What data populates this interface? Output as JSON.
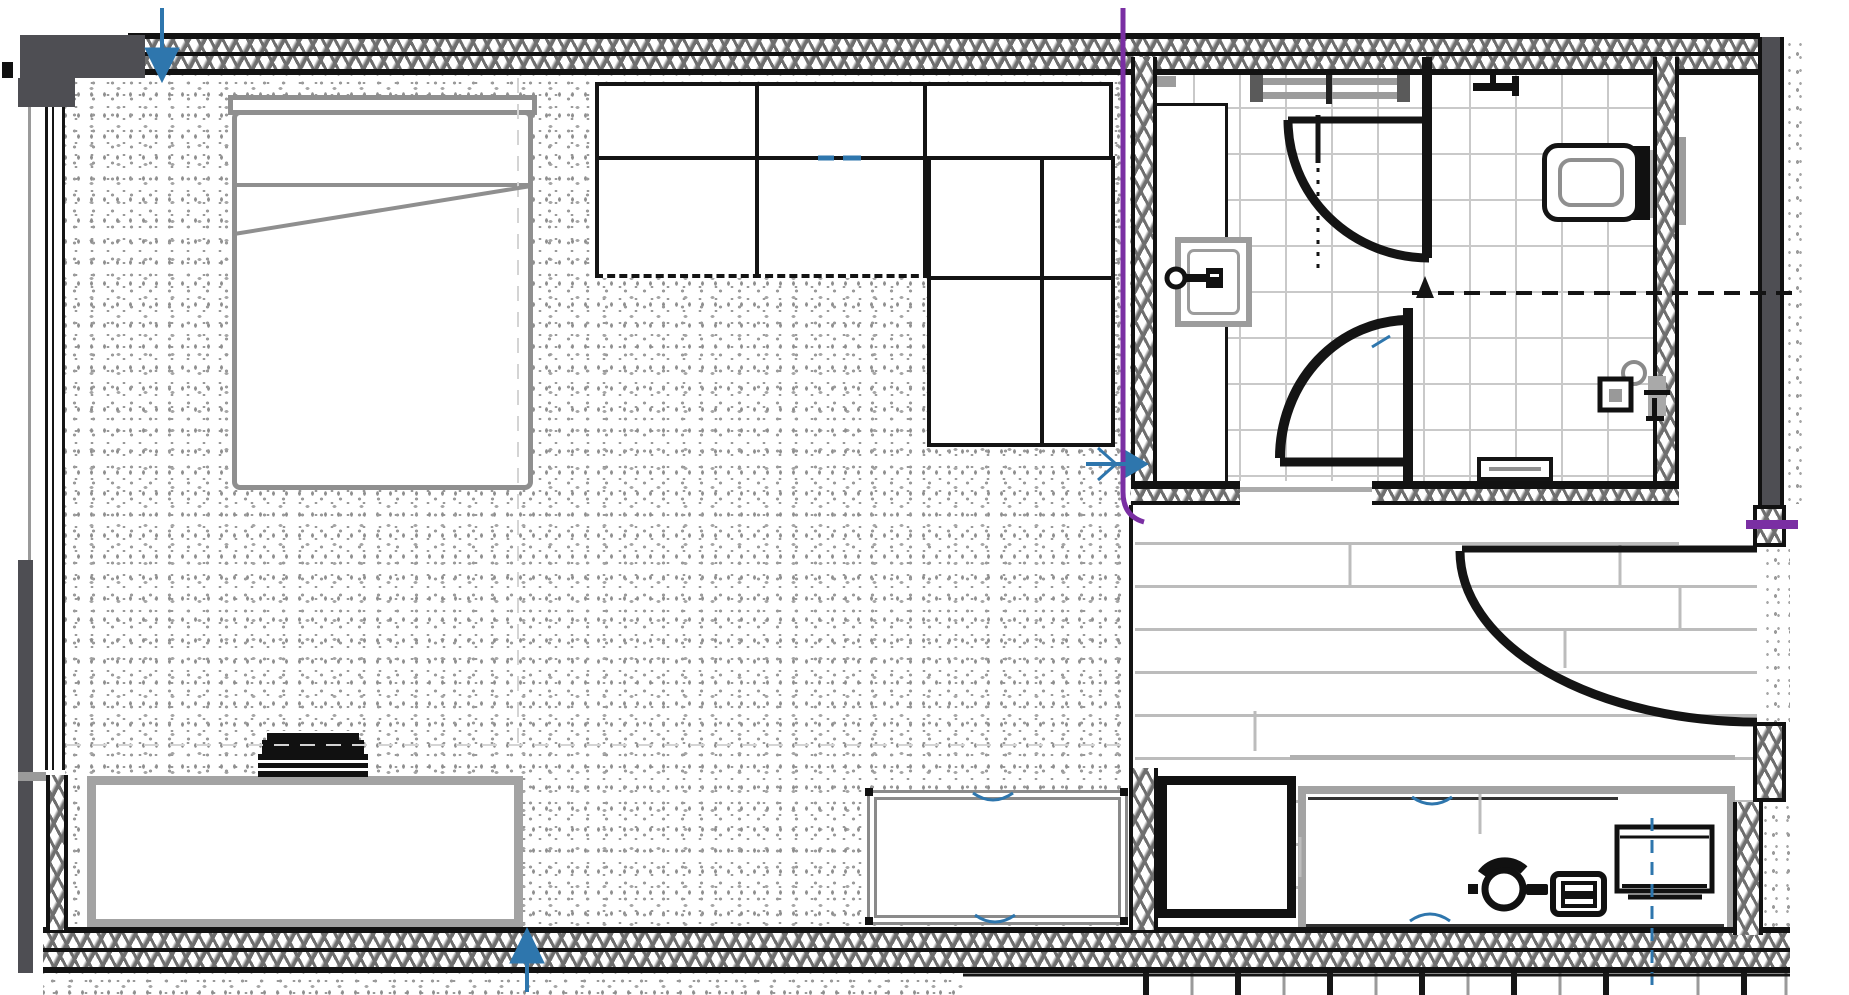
{
  "plan": {
    "name": "hotel guest room floor plan",
    "type": "architectural-floor-plan",
    "colors": {
      "wall_line": "#121212",
      "wall_hatch": "#6e6e6e",
      "charcoal_column": "#4e4e53",
      "furniture_gray": "#a3a3a3",
      "bed_gray": "#8f8f8f",
      "carpet_stipple": "#9b9b9b",
      "tile_grid": "#c9c9c9",
      "wood_plank_line": "#bcbcbc",
      "annotation_purple": "#7a2fa3",
      "annotation_blue": "#2e76ad"
    },
    "rooms": [
      {
        "name": "bedroom-living-area",
        "floor": "carpet-stipple"
      },
      {
        "name": "bathroom-shower-room",
        "floor": "tile"
      },
      {
        "name": "bathroom-wc-room",
        "floor": "tile"
      },
      {
        "name": "entry-hall",
        "floor": "wood-plank"
      }
    ],
    "furniture": [
      {
        "name": "double-bed",
        "details": [
          "headboard",
          "pillow-line",
          "folded-sheet-diagonal"
        ]
      },
      {
        "name": "sectional-sofa",
        "details": [
          "three-back-cushions",
          "two-seat-cushions",
          "corner-chaise"
        ]
      },
      {
        "name": "credenza-dresser"
      },
      {
        "name": "television-on-credenza"
      },
      {
        "name": "coffee-table",
        "details": [
          "double-border",
          "corner-dots"
        ]
      },
      {
        "name": "luggage-rack"
      },
      {
        "name": "work-desk"
      },
      {
        "name": "desk-chair"
      },
      {
        "name": "laptop"
      },
      {
        "name": "desk-monitor"
      },
      {
        "name": "vanity-counter"
      },
      {
        "name": "wash-basin-with-faucet"
      },
      {
        "name": "toilet-with-cistern"
      },
      {
        "name": "bath-mat"
      },
      {
        "name": "sliding-shower-door-track"
      },
      {
        "name": "shower-arm"
      },
      {
        "name": "toilet-paper-holder-and-sprayer"
      }
    ],
    "doors": [
      {
        "name": "entry-door",
        "swing": "quarter-arc",
        "location": "right-wall"
      },
      {
        "name": "bathroom-door",
        "swing": "quarter-arc",
        "location": "bathroom-south-wall"
      },
      {
        "name": "shower-room-door",
        "swing": "quarter-arc",
        "location": "bathroom-divider-wall"
      }
    ],
    "annotations": {
      "purple_riser_line": {
        "color": "#7a2fa3",
        "path": "vertical line along bathroom left wall with hook at bottom plus tick on right wall"
      },
      "blue_arrows": [
        {
          "name": "arrow-down-top-left"
        },
        {
          "name": "arrow-right-mid"
        },
        {
          "name": "arrow-up-bottom"
        }
      ],
      "blue_dashed_line": {
        "name": "centerline-through-monitor"
      },
      "blue_tick_marks": [
        "sofa-seat-dash",
        "table-edge-arcs",
        "desk-edge-arcs",
        "door-arc-tick"
      ],
      "dashed_bulkhead_line": {
        "name": "overhead-hidden-edge",
        "y_position": "across wc-room and shaft"
      }
    },
    "balcony_railing_ticks": 15
  }
}
